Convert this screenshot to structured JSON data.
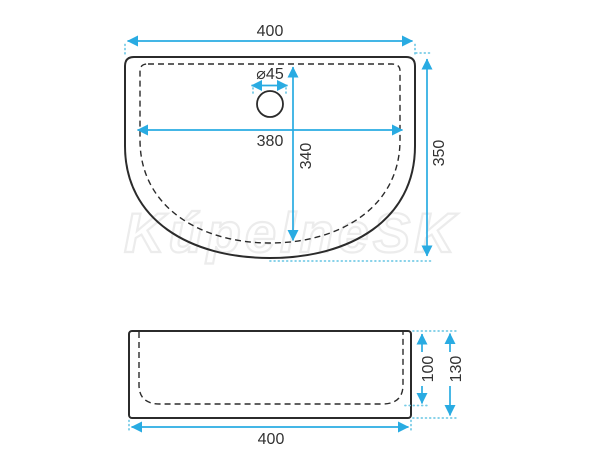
{
  "drawing": {
    "watermark": "KúpelneSK",
    "colors": {
      "dimension_line": "#29ABE2",
      "extension_line": "#76CBE6",
      "outline": "#2B2B2B",
      "label_text": "#333333",
      "background": "#FFFFFF"
    },
    "top_view": {
      "labels": {
        "overall_width": "400",
        "overall_depth": "350",
        "inner_width": "380",
        "inner_depth": "340",
        "drain_diameter": "⌀45"
      }
    },
    "side_view": {
      "labels": {
        "overall_width": "400",
        "inner_height": "100",
        "overall_height": "130"
      }
    }
  }
}
